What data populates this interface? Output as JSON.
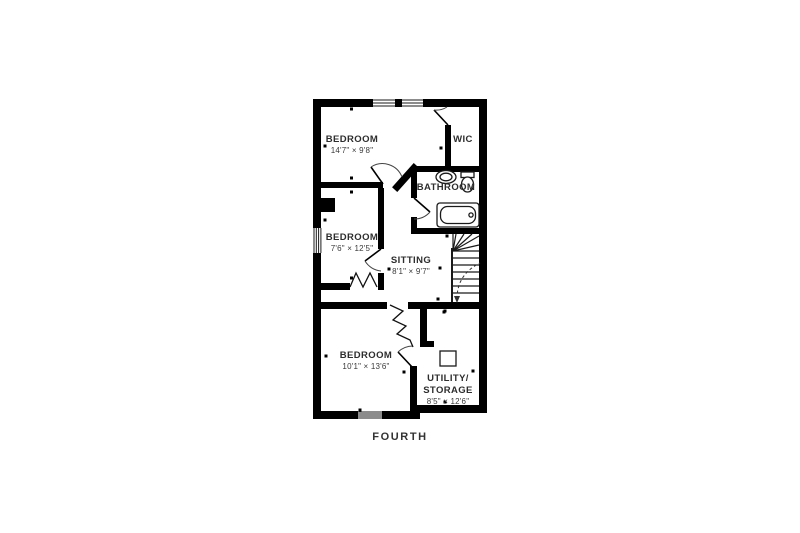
{
  "floor_plan": {
    "floor_label": "FOURTH",
    "rooms": {
      "bedroom_top": {
        "name": "BEDROOM",
        "dims": "14'7\" × 9'8\""
      },
      "wic": {
        "name": "WIC"
      },
      "bathroom": {
        "name": "BATHROOM"
      },
      "bedroom_mid": {
        "name": "BEDROOM",
        "dims": "7'6\" × 12'5\""
      },
      "sitting": {
        "name": "SITTING",
        "dims": "8'1\" × 9'7\""
      },
      "bedroom_bottom": {
        "name": "BEDROOM",
        "dims": "10'1\" × 13'6\""
      },
      "utility": {
        "name_line1": "UTILITY/",
        "name_line2": "STORAGE",
        "dims": "8'5\" × 12'6\""
      }
    },
    "fixtures": [
      "bathtub",
      "sink",
      "toilet",
      "winder-staircase",
      "roof-hatch",
      "windows",
      "door-swings"
    ],
    "colors": {
      "wall": "#000000",
      "line": "#1a1a1a",
      "text": "#2d2d2d",
      "background": "#ffffff"
    }
  }
}
